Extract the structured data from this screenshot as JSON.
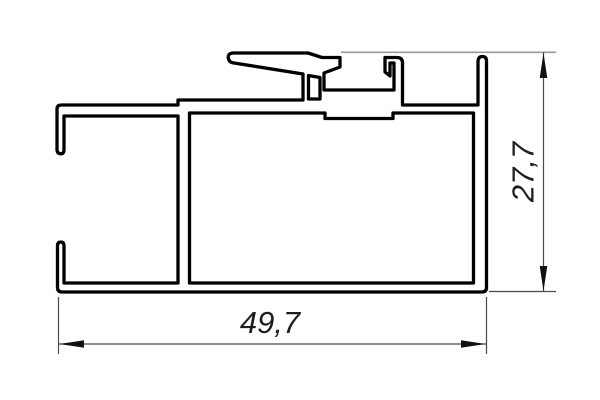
{
  "drawing": {
    "colors": {
      "background": "#ffffff",
      "profile_outline": "#000000",
      "dimension_lines": "#4a4a4a",
      "extension_line_top": "#9a9a9a",
      "text": "#1d1d1d"
    },
    "dimensions": {
      "width_label": "49,7",
      "height_label": "27,7"
    }
  }
}
